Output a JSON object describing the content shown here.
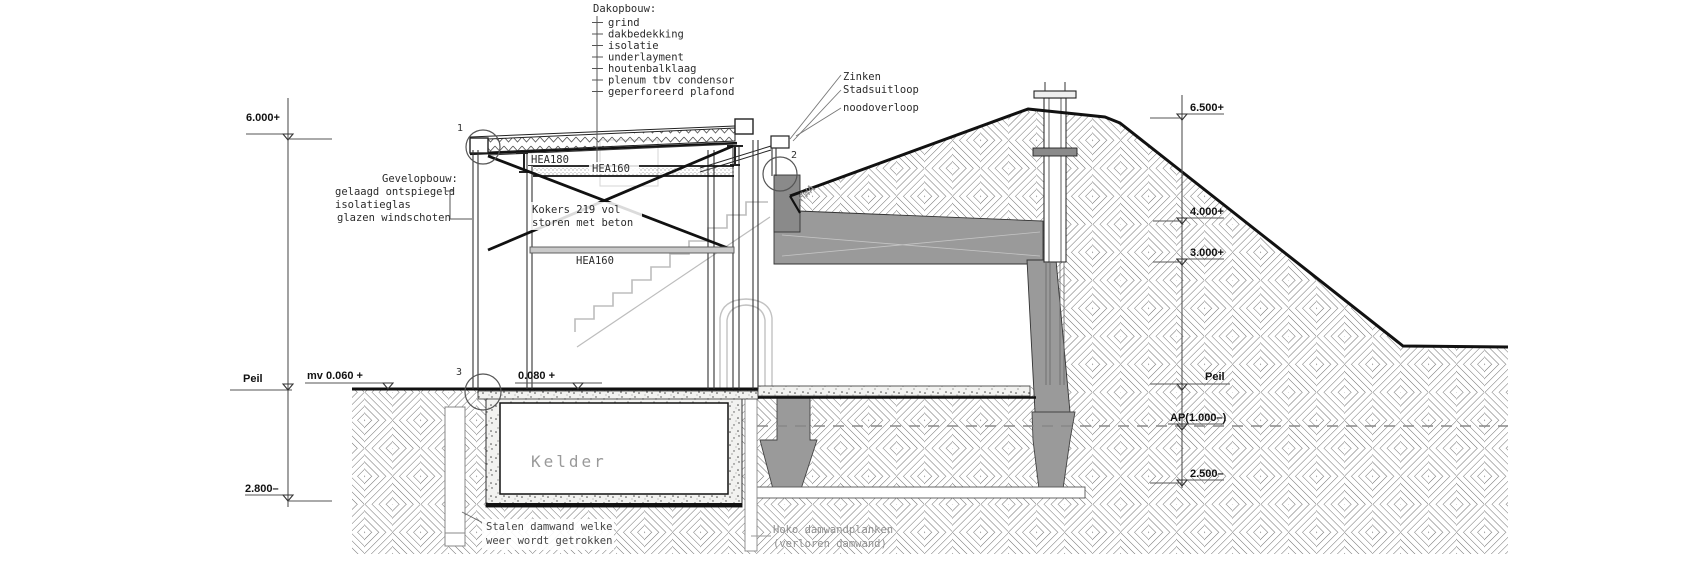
{
  "drawing": {
    "type": "architectural-section",
    "description": "Cross section of glass pavilion with basement (kelder) built against an earth-covered casemate/dike"
  },
  "annotations": {
    "dakopbouw": {
      "title": "Dakopbouw:",
      "items": [
        "grind",
        "dakbedekking",
        "isolatie",
        "underlayment",
        "houtenbalklaag",
        "plenum tbv condensor",
        "geperforeerd plafond"
      ]
    },
    "gevelopbouw": {
      "title": "Gevelopbouw:",
      "items": [
        "gelaagd ontspiegeld",
        "isolatieglas",
        "glazen windschoten"
      ]
    },
    "zinken": "Zinken",
    "stadsuitloop": "Stadsuitloop",
    "noodoverloop": "noodoverloop",
    "hwa": "HWA",
    "kelder": "Kelder",
    "stalen": [
      "Stalen damwand welke",
      "weer wordt getrokken"
    ],
    "hoko": [
      "Hoko damwandplanken",
      "(verloren damwand)"
    ]
  },
  "beams": {
    "hea180": "HEA180",
    "hea160_top": "HEA160",
    "hea160_bottom": "HEA160",
    "kokers": [
      "Kokers 219 vol",
      "storen met beton"
    ]
  },
  "levels": {
    "left": [
      {
        "label": "6.000+"
      },
      {
        "label": "Peil"
      },
      {
        "label": "2.800–"
      }
    ],
    "ground": [
      {
        "label": "mv 0.060 +"
      },
      {
        "label": "0.080 +"
      }
    ],
    "right": [
      {
        "label": "6.500+"
      },
      {
        "label": "4.000+"
      },
      {
        "label": "3.000+"
      },
      {
        "label": "Peil"
      },
      {
        "label": "AP(1.000–)"
      },
      {
        "label": "2.500–"
      }
    ]
  },
  "markers": {
    "c1": "1",
    "c2": "2",
    "c3": "3"
  },
  "colors": {
    "line": "#1c1c1c",
    "hatch": "#707070",
    "concrete": "#9a9a9a",
    "concrete_dark": "#8a8a8a",
    "light_gray": "#bdbdbd",
    "muted_text": "#8f8f8f",
    "dash_line": "#888888"
  }
}
